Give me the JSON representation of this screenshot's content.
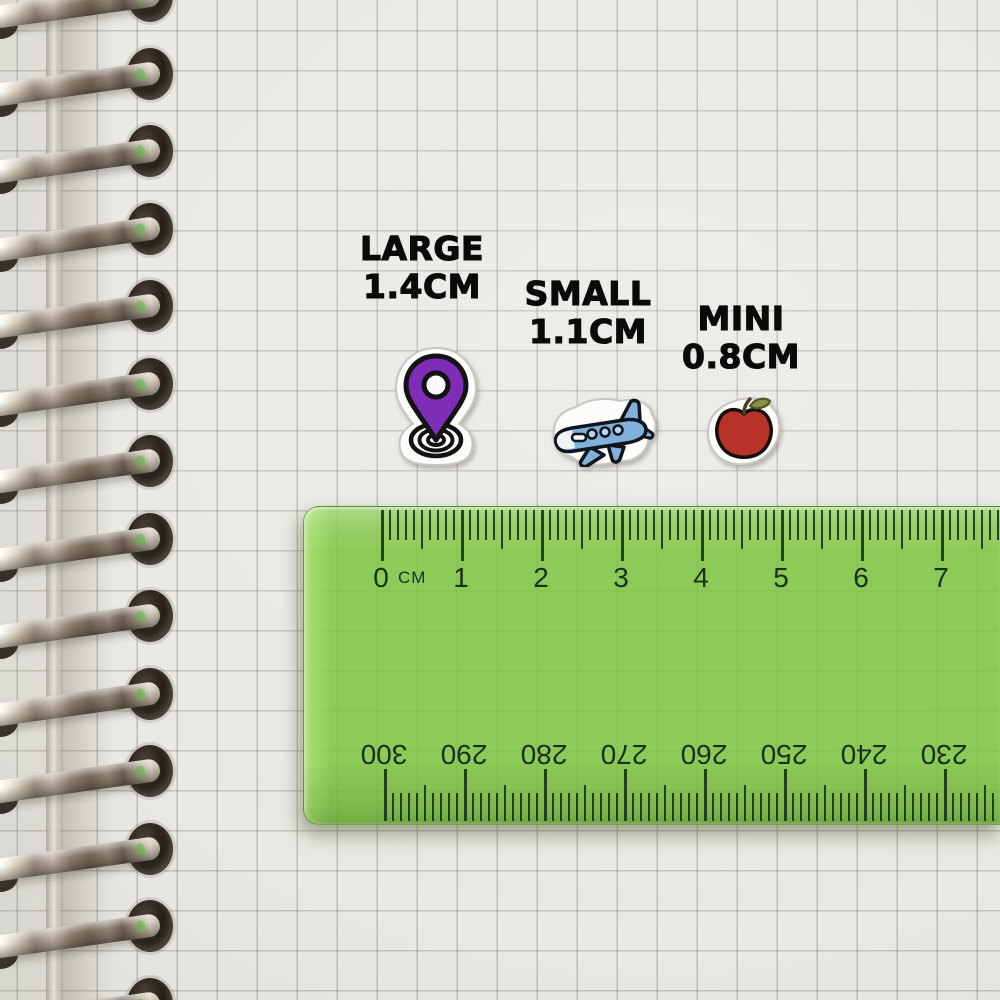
{
  "size_labels": [
    {
      "id": "large",
      "name": "LARGE",
      "size": "1.4CM",
      "sticker": "location-pin"
    },
    {
      "id": "small",
      "name": "SMALL",
      "size": "1.1CM",
      "sticker": "airplane"
    },
    {
      "id": "mini",
      "name": "MINI",
      "size": "0.8CM",
      "sticker": "apple"
    }
  ],
  "ruler": {
    "unit_label": "CM",
    "top_scale_numbers": [
      "0",
      "1",
      "2",
      "3",
      "4",
      "5",
      "6",
      "7"
    ],
    "bottom_scale_numbers": [
      "300",
      "290",
      "280",
      "270",
      "260",
      "250",
      "240",
      "230"
    ],
    "body_color": "#7dc43e",
    "tick_color": "#16321c"
  },
  "binding": {
    "coil_count": 14
  },
  "sticker_colors": {
    "pin_purple": "#7d2db6",
    "plane_blue": "#7fb1da",
    "plane_window_blue": "#b9d8ef",
    "apple_red": "#b73329",
    "leaf_olive": "#8a8f4a"
  }
}
